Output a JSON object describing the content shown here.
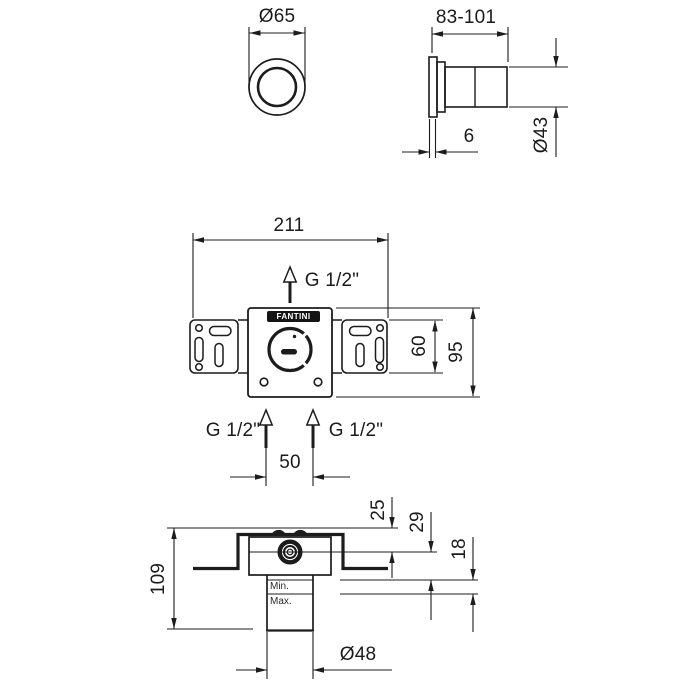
{
  "brand": {
    "logo_text": "FANTINI"
  },
  "views": {
    "handle_front": {
      "diameter": "Ø65"
    },
    "handle_side": {
      "depth_range": "83-101",
      "flange_thickness": "6",
      "diameter": "Ø43"
    },
    "body_front": {
      "overall_width": "211",
      "top_thread": "G 1/2\"",
      "left_thread": "G 1/2\"",
      "right_thread": "G 1/2\"",
      "bracket_height": "60",
      "plate_height": "95",
      "inlet_spacing": "50"
    },
    "body_section": {
      "overall_depth": "109",
      "wall_to_axis": "25",
      "axis_to_min": "29",
      "min_to_max": "18",
      "min_label": "Min.",
      "max_label": "Max.",
      "tail_diameter": "Ø48"
    }
  },
  "colors": {
    "line": "#1c1c1c",
    "background": "#ffffff",
    "logo_bg": "#141414",
    "logo_fg": "#ffffff"
  }
}
